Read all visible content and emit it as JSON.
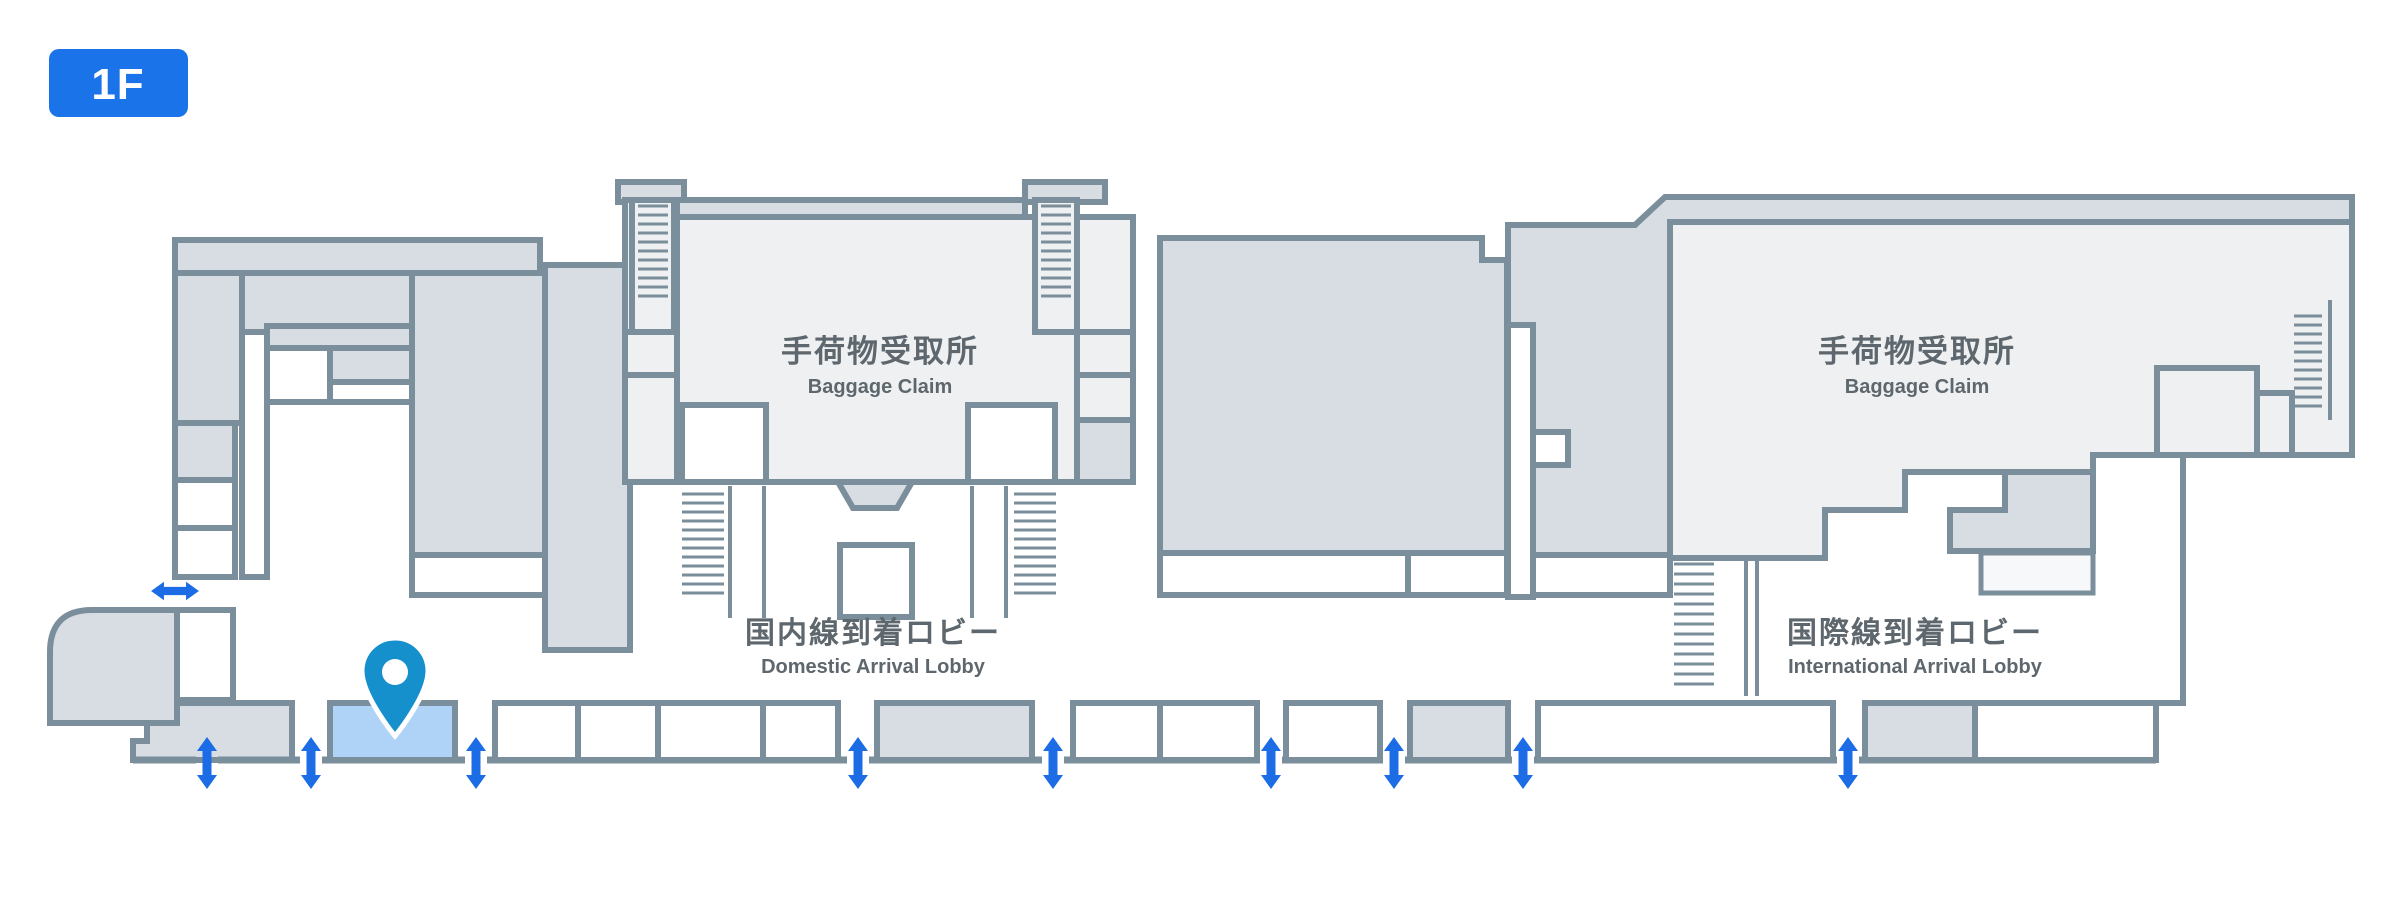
{
  "floor_badge": "1F",
  "areas": {
    "domestic_baggage_claim": {
      "jp": "手荷物受取所",
      "en": "Baggage Claim"
    },
    "international_baggage_claim": {
      "jp": "手荷物受取所",
      "en": "Baggage Claim"
    },
    "domestic_arrival_lobby": {
      "jp": "国内線到着ロビー",
      "en": "Domestic Arrival Lobby"
    },
    "international_arrival_lobby": {
      "jp": "国際線到着ロビー",
      "en": "International Arrival Lobby"
    }
  },
  "colors": {
    "wall": "#7a8e9b",
    "floor_light": "#eef0f1",
    "floor_dark": "#d7dde2",
    "floor_white": "#ffffff",
    "highlight_booth": "#aed3f6",
    "entrance_arrow": "#1c6ce6",
    "location_pin": "#1690cd",
    "floor_badge_bg": "#1a73e8",
    "label_text": "#5d676d"
  },
  "icons": {
    "location_pin": "map-pin",
    "entrance_arrow": "double-headed-arrow"
  }
}
